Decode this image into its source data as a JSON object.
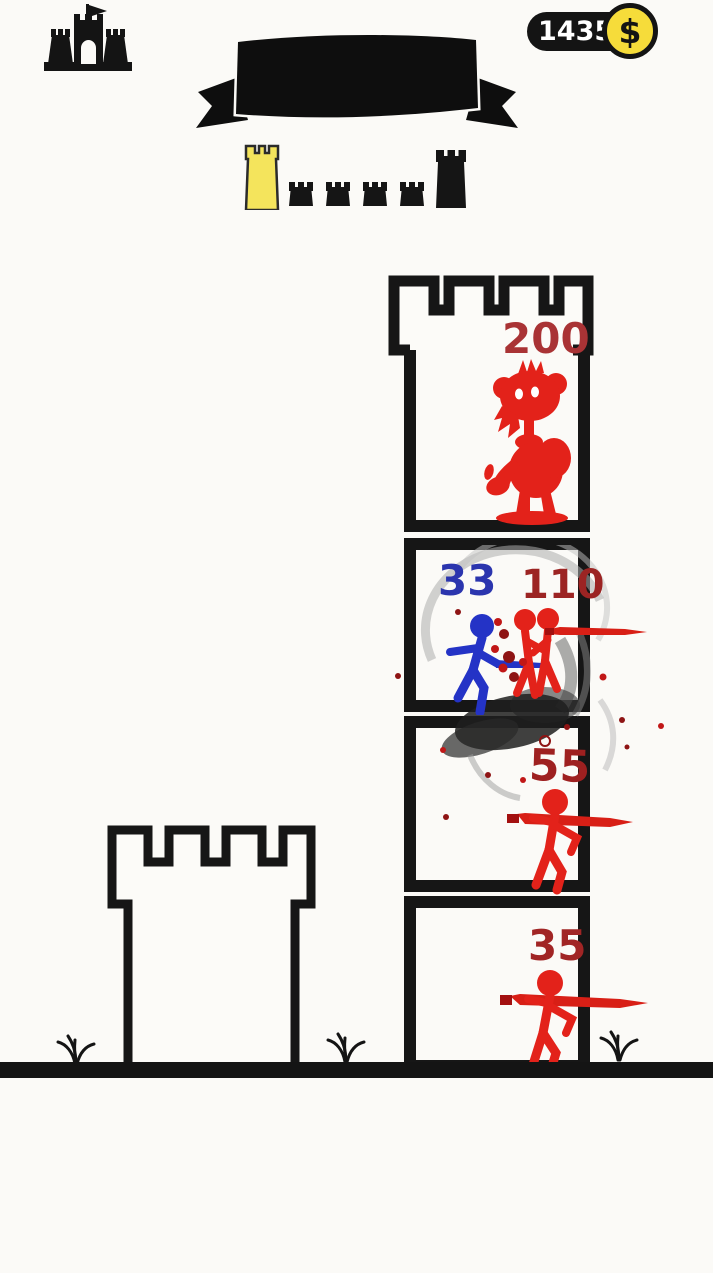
{
  "header": {
    "castle_button": {
      "icon": "castle-flag-icon"
    },
    "coin_counter": {
      "amount": "14350",
      "currency_symbol": "$"
    },
    "banner": {
      "text": ""
    },
    "level_progress": {
      "towers": [
        {
          "state": "current"
        },
        {
          "state": "upcoming"
        },
        {
          "state": "upcoming"
        },
        {
          "state": "upcoming"
        },
        {
          "state": "upcoming"
        },
        {
          "state": "final"
        }
      ]
    }
  },
  "battle": {
    "enemy_tower_floors": [
      {
        "position": "top",
        "enemy": "boss-monster",
        "hp": "200"
      },
      {
        "position": "upper-middle",
        "ally": "blue-stickman",
        "ally_hp": "33",
        "enemy": "red-stickman-pair",
        "enemy_hp": "110",
        "effects": [
          "smoke-swirl",
          "blood-splatter"
        ]
      },
      {
        "position": "lower-middle",
        "enemy": "red-swordsman",
        "hp": "55",
        "effects": [
          "dark-smoke",
          "blood-splatter"
        ]
      },
      {
        "position": "bottom",
        "enemy": "red-swordsman",
        "hp": "35"
      }
    ],
    "player_tower": {
      "style": "outline",
      "floors": 1
    }
  },
  "theme": {
    "background": "#fbfaf7",
    "outline_black": "#141414",
    "enemy_red": "#e3221a",
    "ally_blue": "#2433c6",
    "enemy_hp_red": "#9c2423",
    "ally_hp_blue": "#2b35ae",
    "boss_hp_red": "#a93335",
    "coin_yellow": "#f6dc3a",
    "current_tower_yellow": "#f4e45c"
  }
}
